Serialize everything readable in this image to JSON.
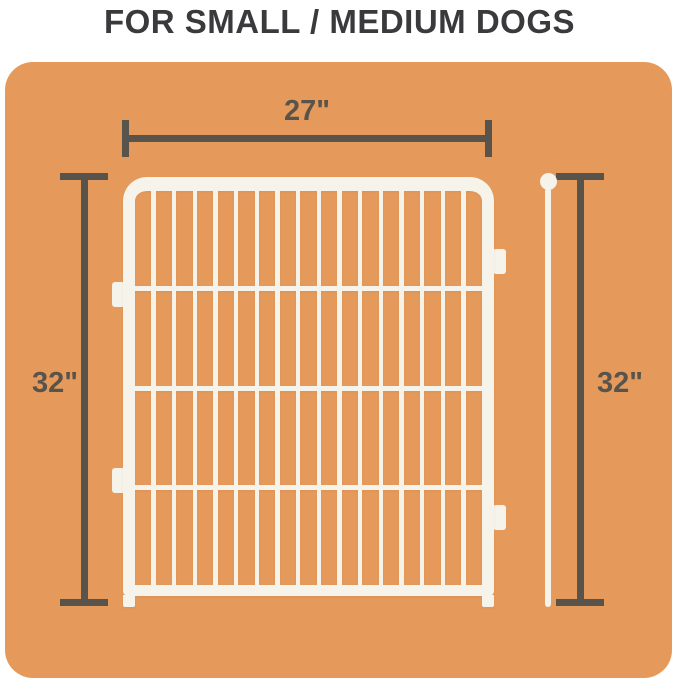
{
  "title": "FOR SMALL / MEDIUM DOGS",
  "dimensions": {
    "width": "27\"",
    "height_left": "32\"",
    "height_right": "32\""
  },
  "illustration": {
    "fence_panel": {
      "vertical_bars": 16,
      "horizontal_crossbars": 3,
      "connector_tabs": 4
    },
    "ground_stake": {
      "present": true
    }
  },
  "colors": {
    "background": "#FFFFFF",
    "panel_orange": "#E59A5B",
    "fence_white": "#F6F3EA",
    "dimension_gray": "#59544B",
    "title_charcoal": "#3A3A3C"
  }
}
